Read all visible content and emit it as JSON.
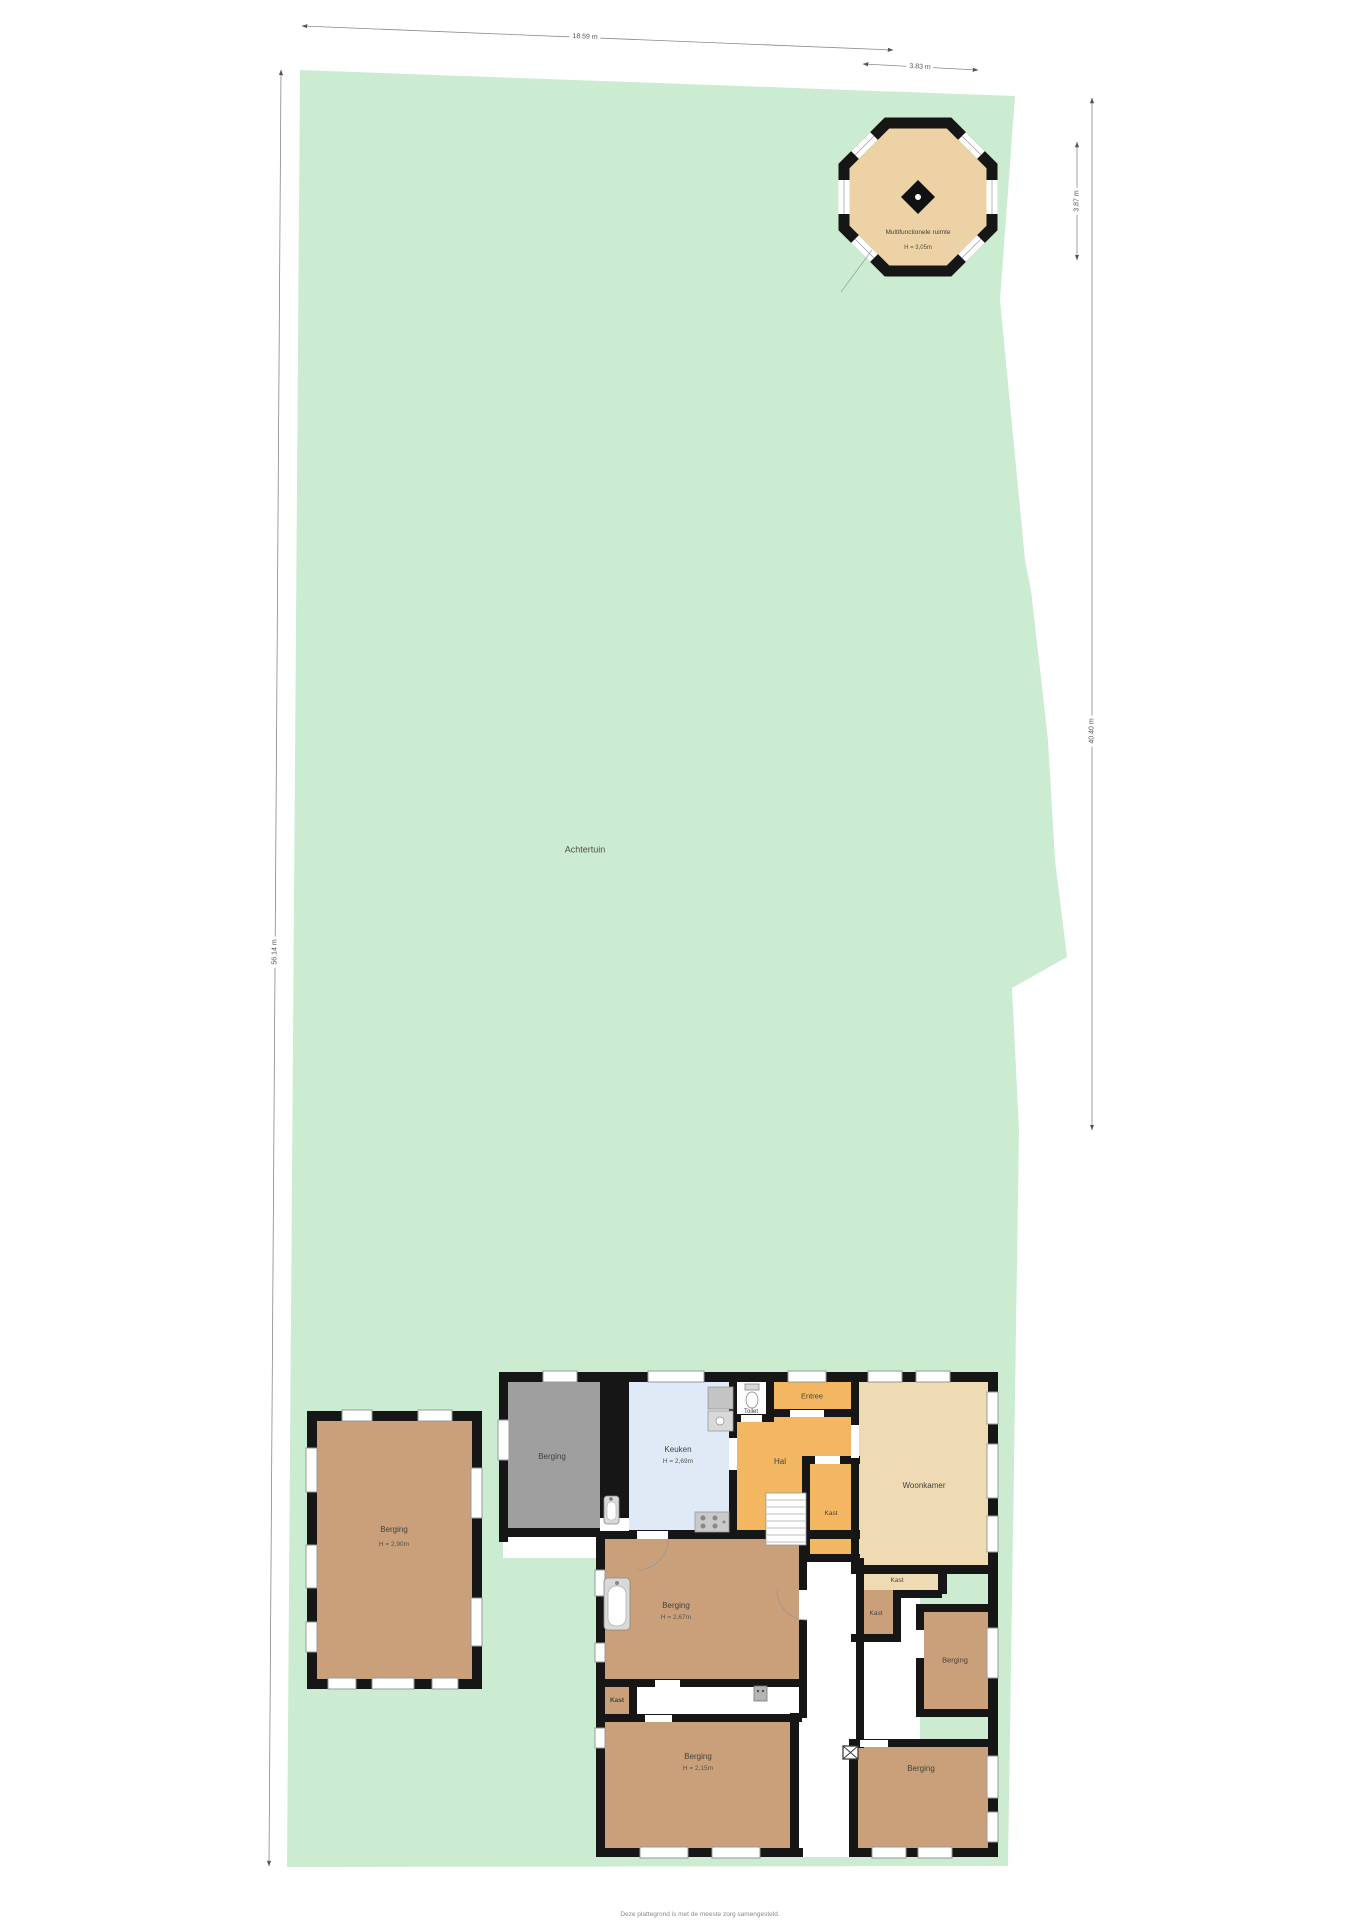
{
  "garden": {
    "label": "Achtertuin"
  },
  "dimensions": {
    "top_width": "18.59 m",
    "octagon_width": "3.83 m",
    "octagon_height": "3.87 m",
    "right_length": "40.40 m",
    "left_length": "56.14 m"
  },
  "octagon": {
    "name": "Multifunctionele ruimte",
    "height": "H = 3,05m"
  },
  "outbuilding": {
    "name": "Berging",
    "height": "H = 2,90m"
  },
  "house": {
    "berging_top": "Berging",
    "keuken": {
      "name": "Keuken",
      "height": "H = 2,69m"
    },
    "toilet": "Toilet",
    "entree": "Entree",
    "hal": "Hal",
    "kast_hal": "Kast",
    "woonkamer": "Woonkamer",
    "kast_strip": "Kast",
    "kast_mid": "Kast",
    "berging_mid": "Berging",
    "berging_center": {
      "name": "Berging",
      "height": "H = 2,67m"
    },
    "kast_bold": "Kast",
    "berging_sw": {
      "name": "Berging",
      "height": "H = 2,15m"
    },
    "berging_se": "Berging"
  },
  "footer": {
    "line1": "Deze plattegrond is met de meeste zorg samengesteld.",
    "line2": "Er kunnen geen rechten aan worden ontleend."
  },
  "colors": {
    "garden": "#cbecd1",
    "wall": "#161616",
    "storage_brown": "#c9a07a",
    "hall_orange": "#f4b761",
    "kitchen_blue": "#dfeaf6",
    "living_tan": "#eedbb3",
    "octagon_tan": "#ecd2a4",
    "gray_room": "#9f9f9f"
  }
}
